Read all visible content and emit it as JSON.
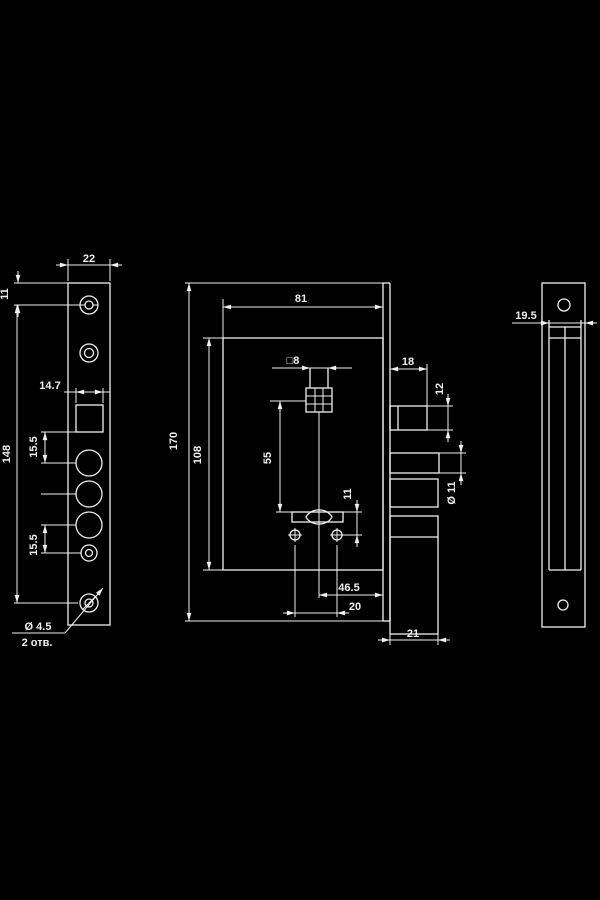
{
  "meta": {
    "type": "technical-drawing",
    "subject": "mortise lock dimension drawing, three views",
    "background_color": "#000000",
    "line_color": "#f0f0f0"
  },
  "dims": {
    "left": {
      "plate_width": "22",
      "top_hole_offset": "11",
      "latch_cutout_width": "14.7",
      "mounting_hole_spacing": "148",
      "pitch_upper": "15.5",
      "pitch_lower": "15.5",
      "screw_hole_dia": "Ø 4.5",
      "screw_hole_count": "2 отв."
    },
    "middle": {
      "case_depth": "81",
      "faceplate_height": "170",
      "case_height": "108",
      "spindle_square": "□8",
      "spindle_to_cylinder": "55",
      "cylinder_pin_offset": "11",
      "latch_throw": "18",
      "latch_height": "12",
      "bolt_dia": "Ø 11",
      "backset": "46.5",
      "fixing_hole_spacing": "20",
      "bottom_throw": "21"
    },
    "right": {
      "strike_width": "19.5"
    }
  }
}
